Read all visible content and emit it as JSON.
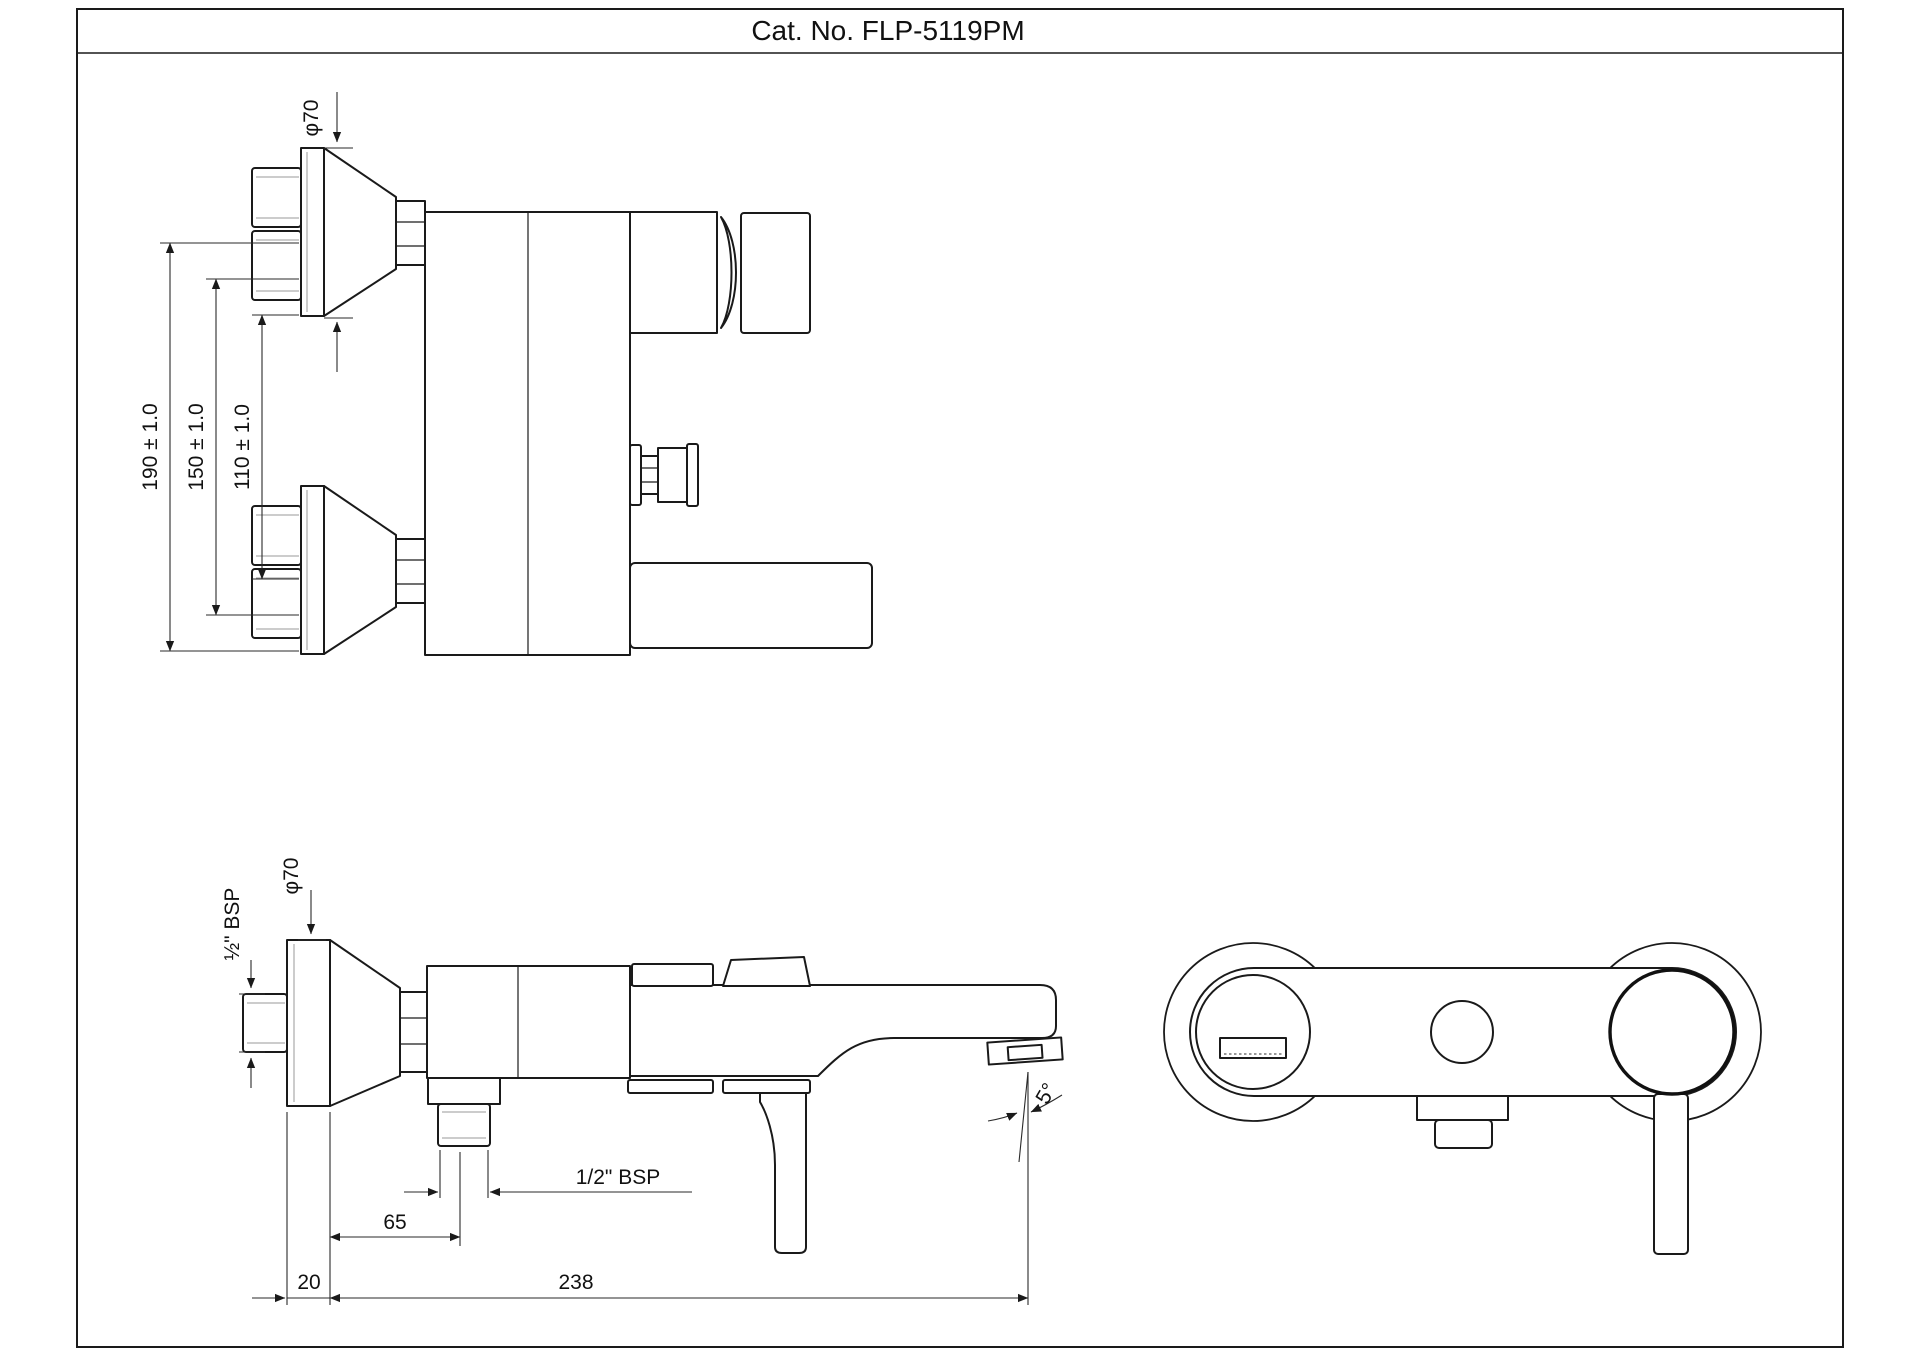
{
  "title": "Cat. No. FLP-5119PM",
  "colors": {
    "line": "#1a1a1a",
    "background": "#ffffff"
  },
  "top_view": {
    "dims": {
      "phi70": "φ70",
      "d190": "190 ± 1.0",
      "d150": "150 ± 1.0",
      "d110": "110 ± 1.0"
    }
  },
  "front_view": {
    "dims": {
      "phi70": "φ70",
      "bsp_vertical": "½\" BSP",
      "bsp_horizontal": "1/2\" BSP",
      "d65": "65",
      "d20": "20",
      "d238": "238",
      "angle": "5°"
    }
  }
}
